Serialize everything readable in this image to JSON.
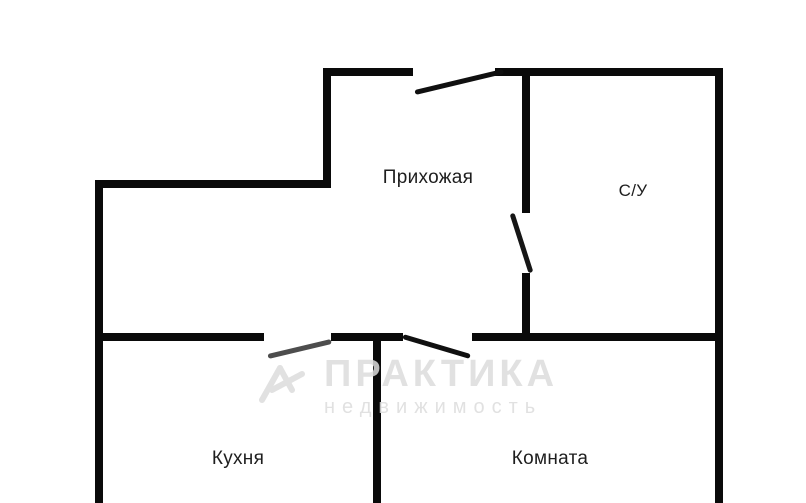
{
  "plan": {
    "background": "#ffffff",
    "wall_color": "#0a0a0a",
    "label_color": "#1e1e1e",
    "rooms": [
      {
        "id": "hallway",
        "label": "Прихожая"
      },
      {
        "id": "bathroom",
        "label": "С/У"
      },
      {
        "id": "kitchen",
        "label": "Кухня"
      },
      {
        "id": "room",
        "label": "Комната"
      }
    ],
    "walls": [
      {
        "name": "top-left-segment",
        "x": 325,
        "y": 68,
        "w": 88,
        "h": 8
      },
      {
        "name": "top-right-segment",
        "x": 495,
        "y": 68,
        "w": 228,
        "h": 8
      },
      {
        "name": "entry-step-vertical",
        "x": 323,
        "y": 68,
        "w": 8,
        "h": 120
      },
      {
        "name": "upper-horizontal",
        "x": 95,
        "y": 180,
        "w": 236,
        "h": 8
      },
      {
        "name": "left-outer",
        "x": 95,
        "y": 180,
        "w": 8,
        "h": 323
      },
      {
        "name": "bathroom-left-top",
        "x": 522,
        "y": 68,
        "w": 8,
        "h": 145
      },
      {
        "name": "bathroom-left-bottom",
        "x": 522,
        "y": 273,
        "w": 8,
        "h": 68
      },
      {
        "name": "right-outer",
        "x": 715,
        "y": 68,
        "w": 8,
        "h": 435
      },
      {
        "name": "middle-left-segment",
        "x": 95,
        "y": 333,
        "w": 169,
        "h": 8
      },
      {
        "name": "middle-center-segment",
        "x": 331,
        "y": 333,
        "w": 72,
        "h": 8
      },
      {
        "name": "middle-right-segment",
        "x": 472,
        "y": 333,
        "w": 251,
        "h": 8
      },
      {
        "name": "kitchen-room-divider",
        "x": 373,
        "y": 333,
        "w": 8,
        "h": 170
      }
    ],
    "doors": [
      {
        "name": "entrance-swing",
        "x": 415,
        "y": 90,
        "length": 91,
        "angle": -13.4,
        "color": "#101010"
      },
      {
        "name": "bathroom-swing",
        "x": 512,
        "y": 211,
        "length": 62,
        "angle": 72.2,
        "color": "#161616"
      },
      {
        "name": "kitchen-swing",
        "x": 268,
        "y": 354,
        "length": 65,
        "angle": -13.4,
        "color": "#4d4d4d"
      },
      {
        "name": "room-swing",
        "x": 403,
        "y": 334,
        "length": 70,
        "angle": 16.6,
        "color": "#101010"
      }
    ]
  },
  "watermark": {
    "brand": "ПРАКТИКА",
    "tagline": "недвижимость",
    "color": "#dcdcdc"
  }
}
